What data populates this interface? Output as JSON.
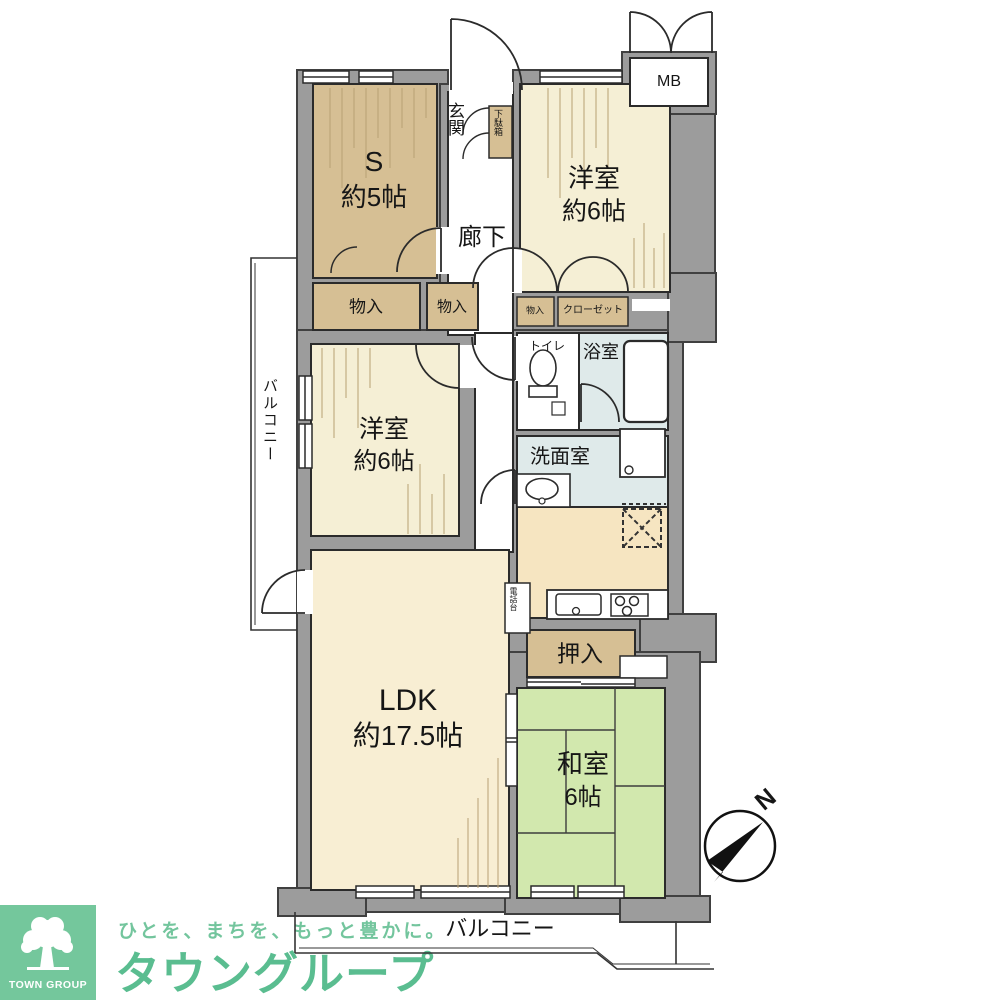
{
  "plan": {
    "rooms": {
      "service_room": {
        "name": "S",
        "size": "約5帖"
      },
      "western_room_top": {
        "name": "洋室",
        "size": "約6帖"
      },
      "western_room_left": {
        "name": "洋室",
        "size": "約6帖"
      },
      "ldk": {
        "name": "LDK",
        "size": "約17.5帖"
      },
      "japanese_room": {
        "name": "和室",
        "size": "6帖"
      },
      "entrance": "玄関",
      "corridor": "廊下",
      "toilet": "トイレ",
      "bathroom": "浴室",
      "washroom": "洗面室",
      "balcony_left": "バルコニー",
      "balcony_bottom": "バルコニー"
    },
    "storage": {
      "shoe_cabinet": "下駄箱",
      "storage_1": "物入",
      "storage_2": "物入",
      "storage_3": "物入",
      "closet": "クローゼット",
      "oshiire": "押入",
      "phone_stand": "電話台",
      "meter_box": "MB"
    },
    "compass_north": "N"
  },
  "branding": {
    "logo_text": "TOWN GROUP",
    "tagline": "ひとを、まちを、もっと豊かに。",
    "company": "タウングループ"
  },
  "colors": {
    "wall": "#9c9c9c",
    "room_cream": "#f5efd5",
    "room_cream_ldk": "#f8eed3",
    "room_tan": "#d6bf94",
    "room_green": "#d2e8ae",
    "room_blue": "#dfeaea",
    "room_kitchen": "#f6e5c1",
    "logo_green": "#74c79c",
    "tagline_green": "#73c59d",
    "company_green": "#5abd90"
  }
}
